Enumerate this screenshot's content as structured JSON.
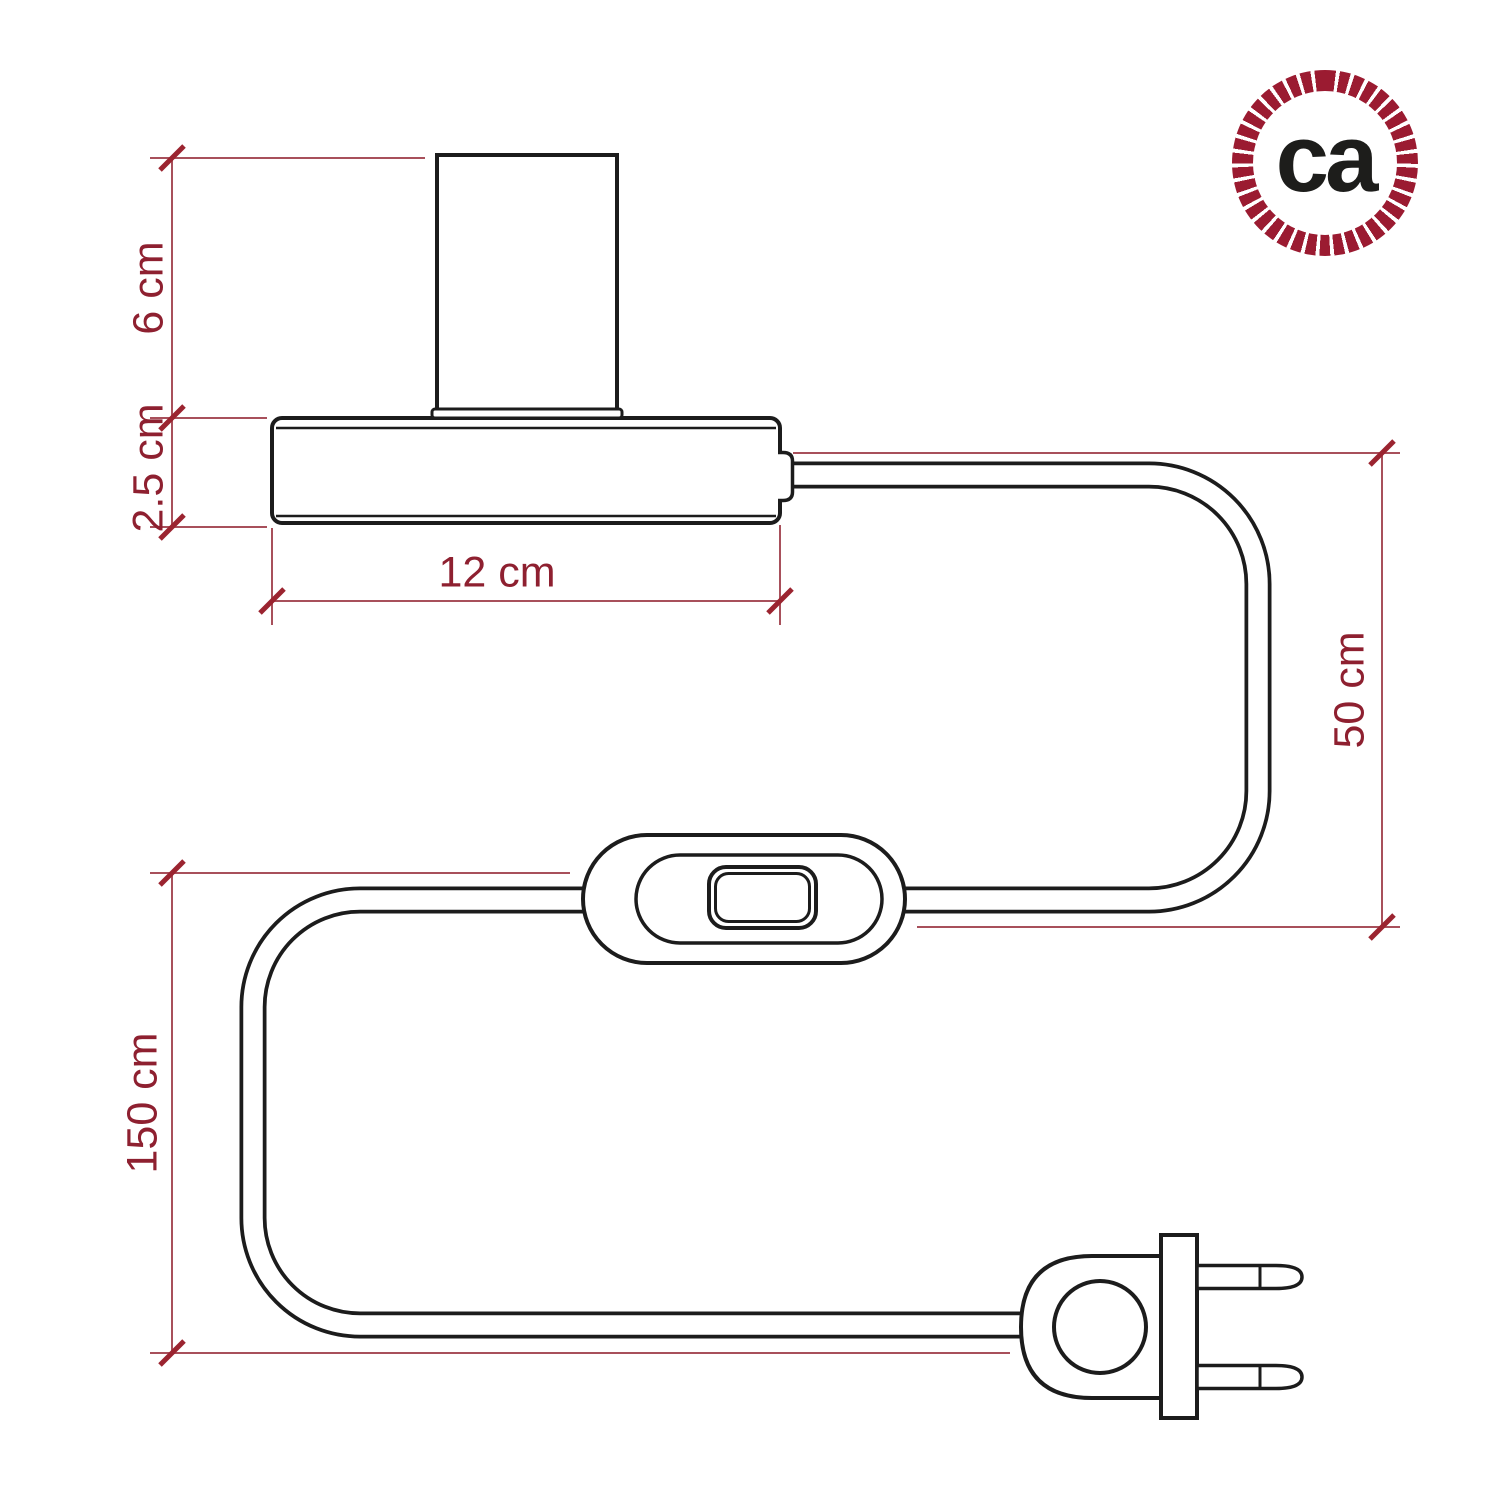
{
  "diagram": {
    "dimensions": [
      {
        "name": "socket-height",
        "label": "6 cm",
        "orientation": "vertical"
      },
      {
        "name": "base-height",
        "label": "2.5 cm",
        "orientation": "vertical"
      },
      {
        "name": "base-width",
        "label": "12 cm",
        "orientation": "horizontal"
      },
      {
        "name": "lamp-to-switch-cable",
        "label": "50 cm",
        "orientation": "vertical"
      },
      {
        "name": "switch-to-plug-cable",
        "label": "150 cm",
        "orientation": "vertical"
      }
    ],
    "line_color": "#1c1c1c",
    "dimension_line_color": "#a8505b",
    "dimension_text_color": "#8e2030"
  },
  "logo": {
    "text": "ca",
    "ring_color": "#9b1b31",
    "text_color": "#1d1d1b"
  },
  "background": "#ffffff"
}
